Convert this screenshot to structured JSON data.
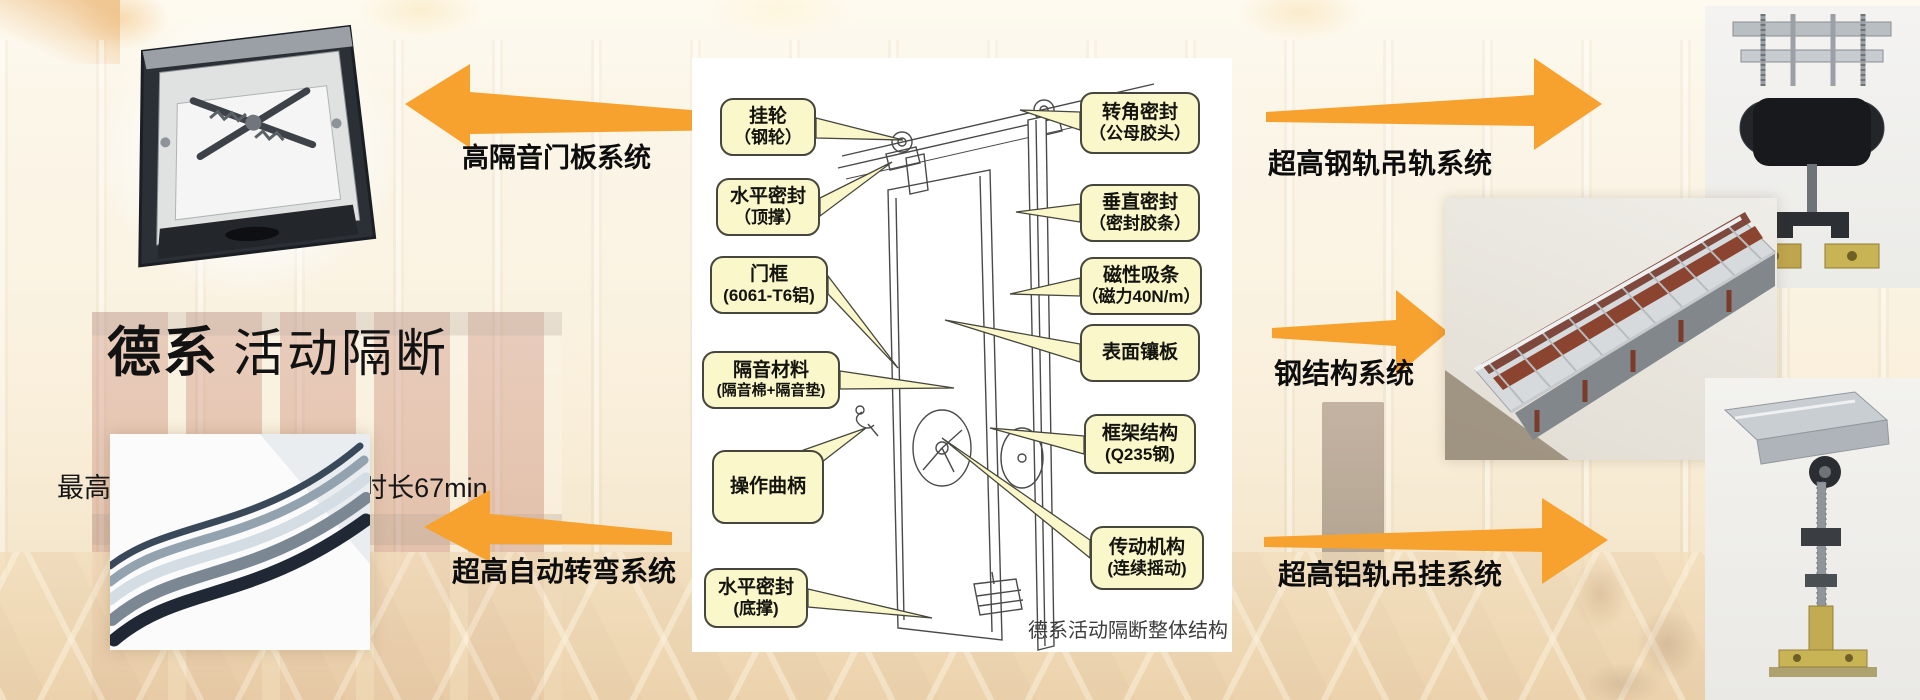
{
  "colors": {
    "arrow": "#F7A12F",
    "label-fill": "#FAF7CB",
    "label-border": "#46463C"
  },
  "hero": {
    "title_bold": "德系",
    "title_light": "活动隔断",
    "subtitle": "最高隔音系数56db，防火时长67min"
  },
  "callouts": {
    "door_panel_system": "高隔音门板系统",
    "auto_turn_system": "超高自动转弯系统",
    "steel_rail_system": "超高钢轨吊轨系统",
    "steel_structure_system": "钢结构系统",
    "alu_rail_system": "超高铝轨吊挂系统"
  },
  "diagram": {
    "caption": "德系活动隔断整体结构",
    "left_labels": [
      {
        "l1": "挂轮",
        "l2": "（钢轮）"
      },
      {
        "l1": "水平密封",
        "l2": "（顶撑）"
      },
      {
        "l1": "门框",
        "l2": "(6061-T6铝)"
      },
      {
        "l1": "隔音材料",
        "l2": "(隔音棉+隔音垫)"
      },
      {
        "l1": "操作曲柄",
        "l2": ""
      },
      {
        "l1": "水平密封",
        "l2": "(底撑)"
      }
    ],
    "right_labels": [
      {
        "l1": "转角密封",
        "l2": "（公母胶头）"
      },
      {
        "l1": "垂直密封",
        "l2": "（密封胶条）"
      },
      {
        "l1": "磁性吸条",
        "l2": "（磁力40N/m）"
      },
      {
        "l1": "表面镶板",
        "l2": ""
      },
      {
        "l1": "框架结构",
        "l2": "(Q235钢)"
      },
      {
        "l1": "传动机构",
        "l2": "(连续摇动)"
      }
    ]
  }
}
